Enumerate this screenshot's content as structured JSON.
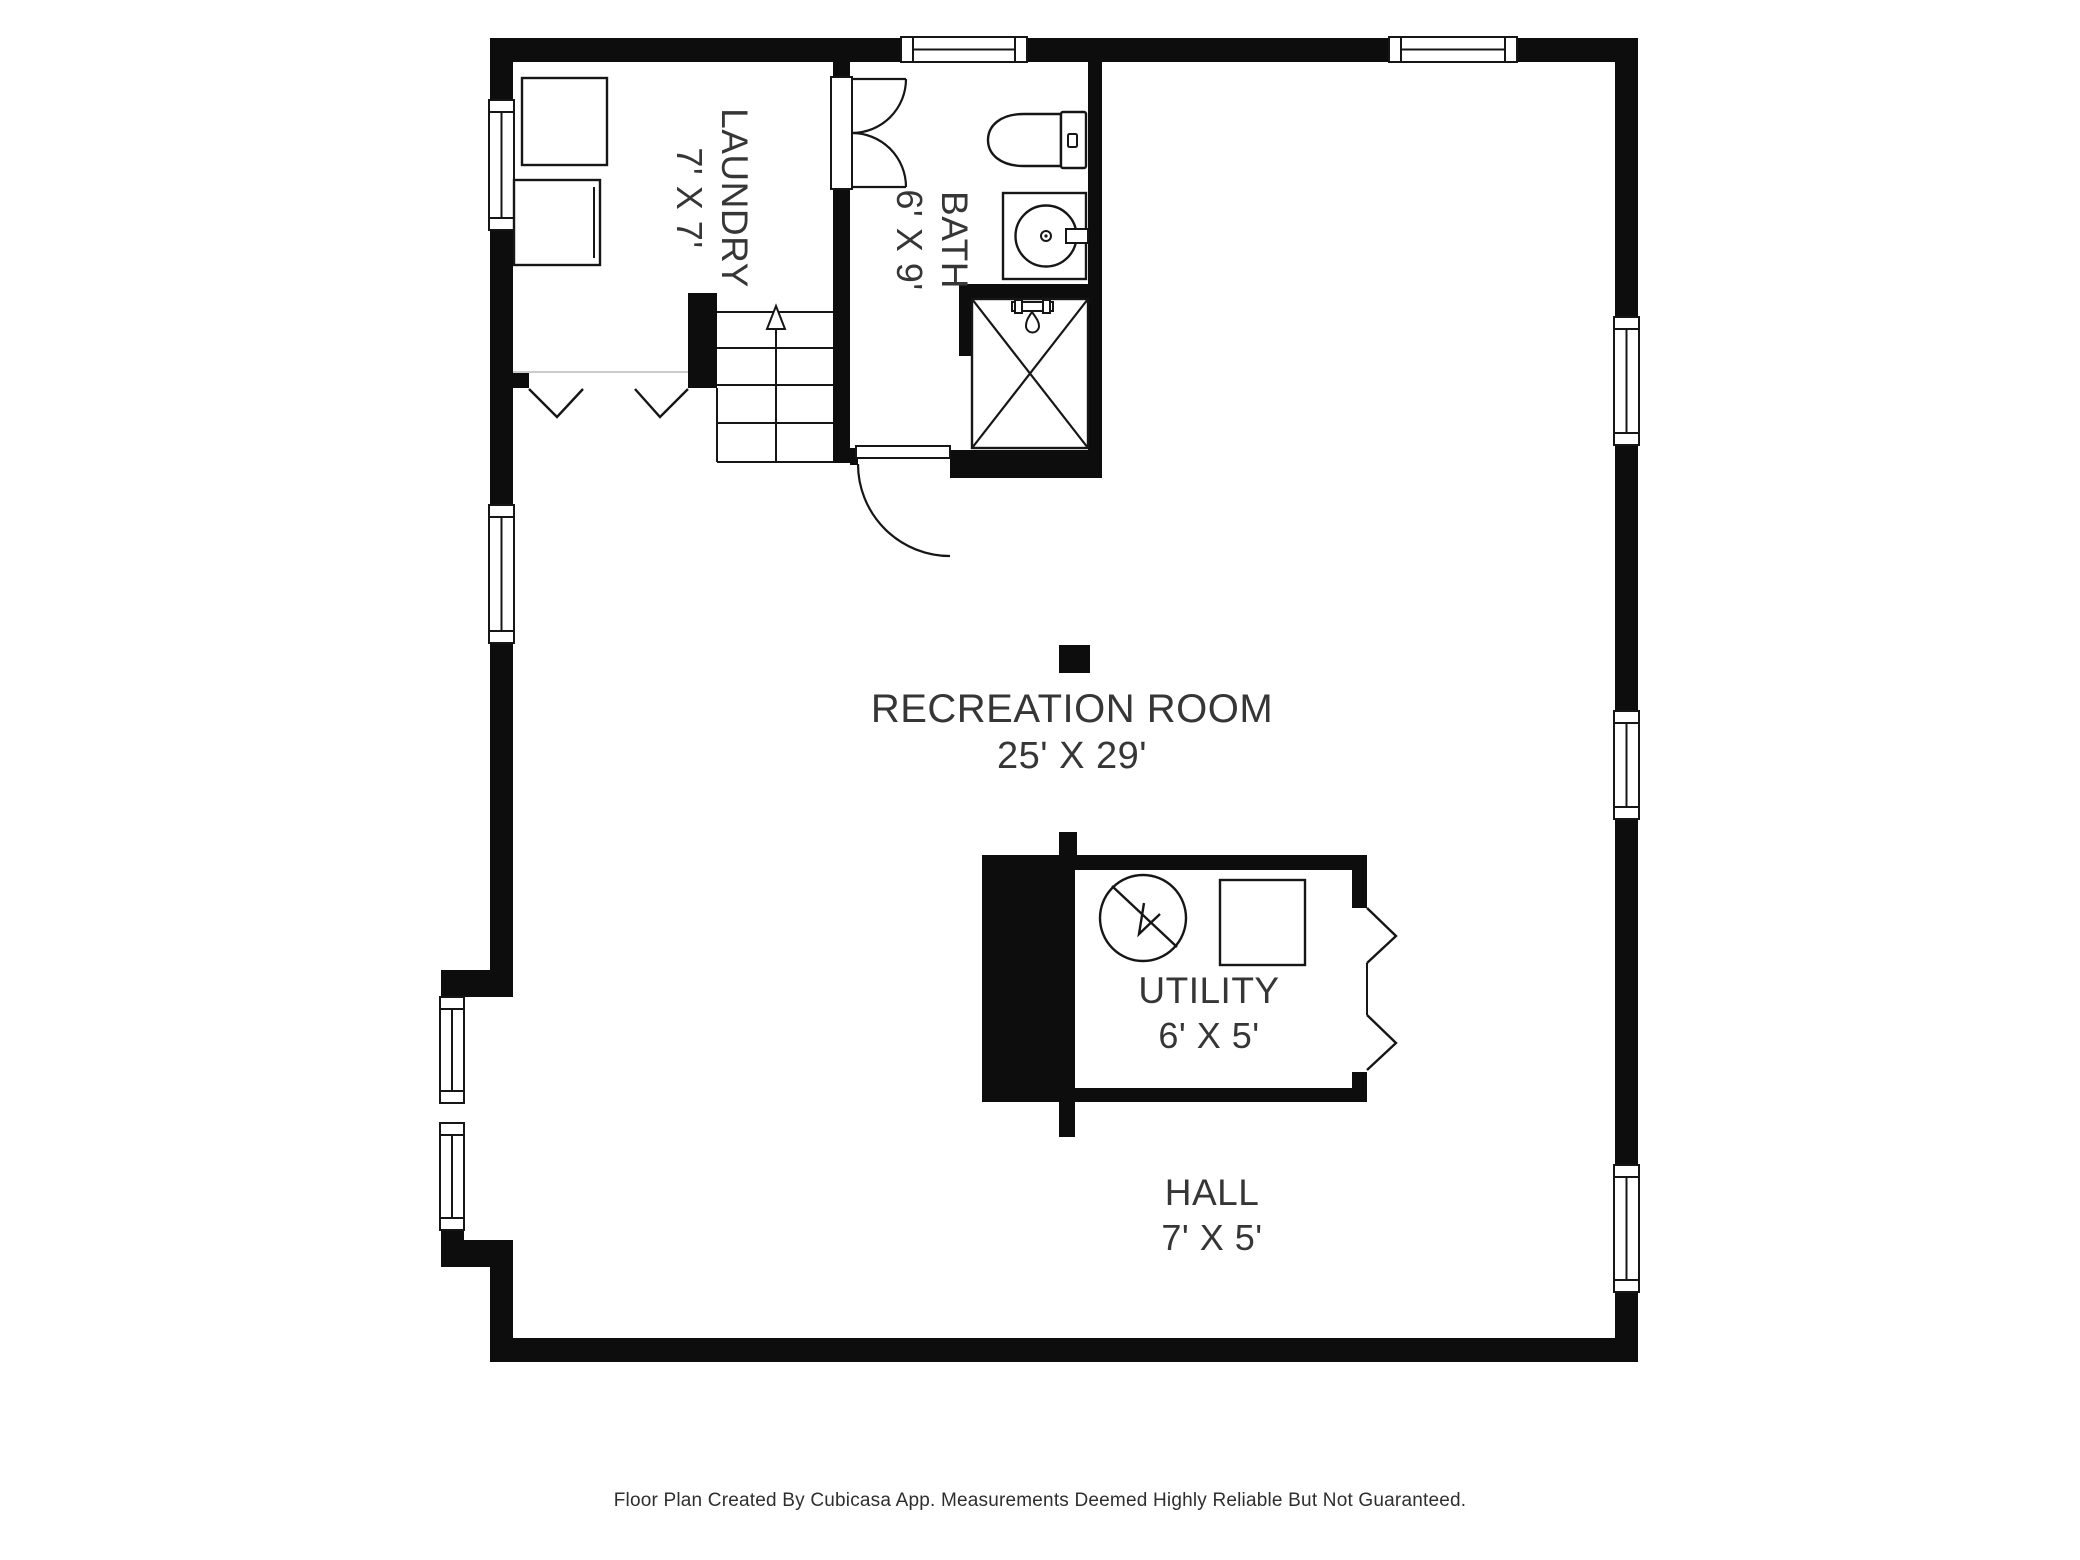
{
  "app": {
    "type": "floor-plan",
    "creator_note_visible": true
  },
  "rooms": {
    "laundry": {
      "name": "LAUNDRY",
      "dims": "7' X 7'"
    },
    "bath": {
      "name": "BATH",
      "dims": "6' X 9'"
    },
    "recreation": {
      "name": "RECREATION ROOM",
      "dims": "25' X 29'"
    },
    "utility": {
      "name": "UTILITY",
      "dims": "6' X 5'"
    },
    "hall": {
      "name": "HALL",
      "dims": "7' X 5'"
    }
  },
  "fixtures": [
    "washer",
    "dryer",
    "toilet",
    "sink",
    "shower",
    "water-heater",
    "furnace",
    "support-post",
    "staircase",
    "up-arrow",
    "windows",
    "doors"
  ],
  "footer": {
    "text": "Floor Plan Created By Cubicasa App. Measurements Deemed Highly Reliable But Not Guaranteed."
  },
  "colors": {
    "background": "#ffffff",
    "wall": "#0d0d0d",
    "line": "#161616",
    "room_boundary": "#cccccc",
    "text": "#363636"
  }
}
